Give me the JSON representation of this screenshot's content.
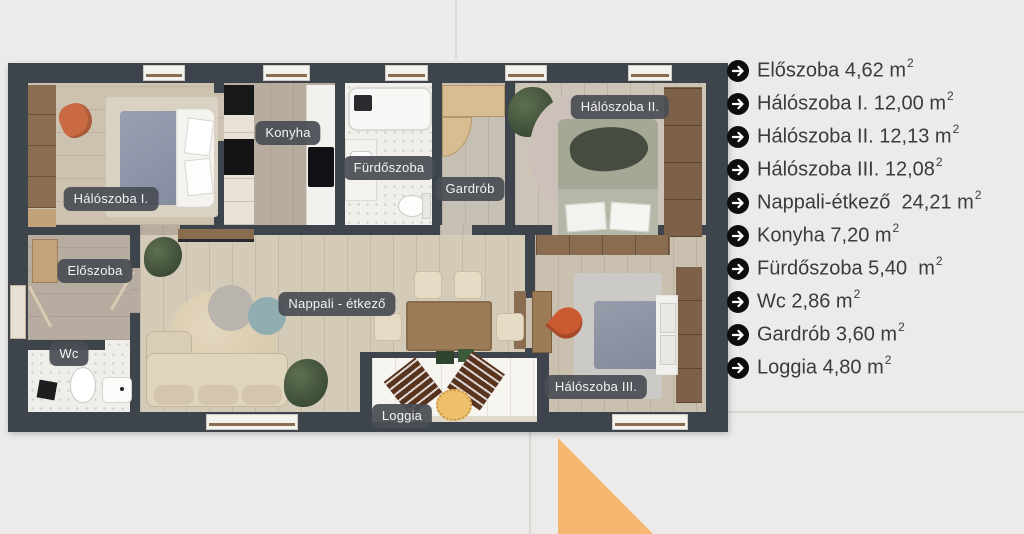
{
  "colors": {
    "wall": "#3e444c",
    "accent": "#f6b76f",
    "pill_bg": "#494e54",
    "legend_text": "#3b3b3d",
    "bullet": "#0d0d0d"
  },
  "rooms": [
    {
      "label": "Hálószoba I."
    },
    {
      "label": "Konyha"
    },
    {
      "label": "Fürdőszoba"
    },
    {
      "label": "Gardrób"
    },
    {
      "label": "Hálószoba II."
    },
    {
      "label": "Előszoba"
    },
    {
      "label": "Wc"
    },
    {
      "label": "Nappali - étkező"
    },
    {
      "label": "Loggia"
    },
    {
      "label": "Hálószoba III."
    }
  ],
  "legend": {
    "items": [
      {
        "text": "Előszoba 4,62 m",
        "sup": "2"
      },
      {
        "text": "Hálószoba I. 12,00 m",
        "sup": "2"
      },
      {
        "text": "Hálószoba II. 12,13 m",
        "sup": "2"
      },
      {
        "text": "Hálószoba III. 12,08",
        "sup": "2"
      },
      {
        "text": "Nappali-étkező  24,21 m",
        "sup": "2"
      },
      {
        "text": "Konyha 7,20 m",
        "sup": "2"
      },
      {
        "text": "Fürdőszoba 5,40  m",
        "sup": "2"
      },
      {
        "text": "Wc 2,86 m",
        "sup": "2"
      },
      {
        "text": "Gardrób 3,60 m",
        "sup": "2"
      },
      {
        "text": "Loggia 4,80 m",
        "sup": "2"
      }
    ]
  }
}
